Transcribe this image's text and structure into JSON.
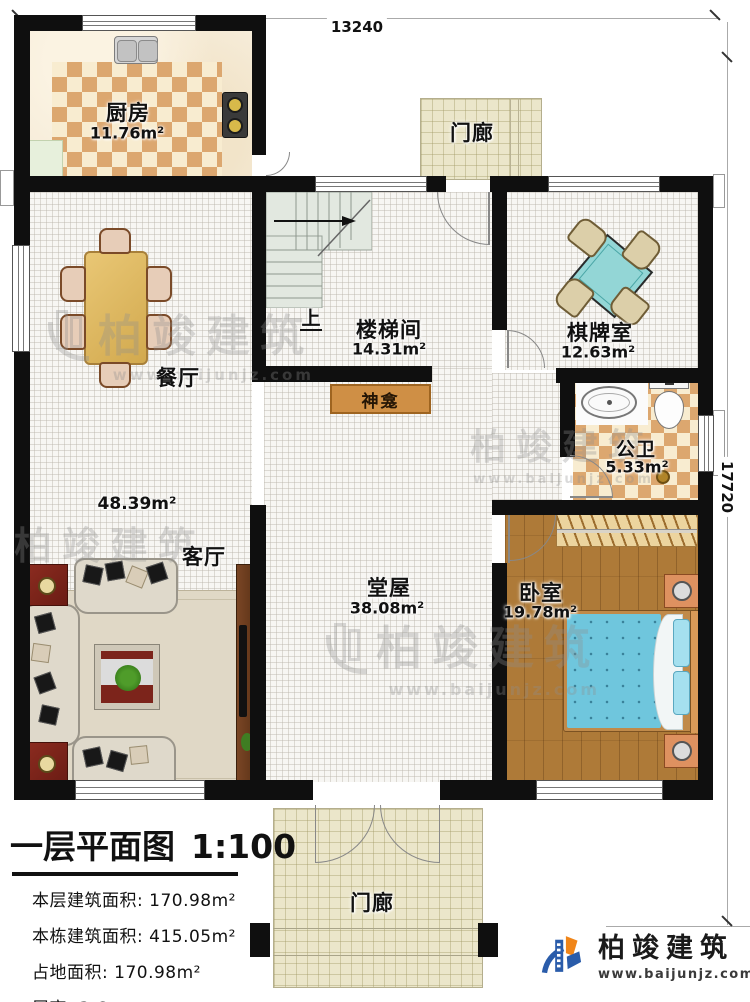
{
  "dimensions": {
    "top": "13240",
    "right": "17720"
  },
  "rooms": {
    "kitchen": {
      "name": "厨房",
      "area": "11.76m²"
    },
    "dining": {
      "name": "餐厅"
    },
    "stair": {
      "name": "楼梯间",
      "area": "14.31m²"
    },
    "chess": {
      "name": "棋牌室",
      "area": "12.63m²"
    },
    "bath": {
      "name": "公卫",
      "area": "5.33m²"
    },
    "bedroom": {
      "name": "卧室",
      "area": "19.78m²"
    },
    "living": {
      "name": "客厅",
      "area": "48.39m²"
    },
    "hall": {
      "name": "堂屋",
      "area": "38.08m²"
    },
    "porch_top": {
      "name": "门廊"
    },
    "porch_bottom": {
      "name": "门廊"
    },
    "shrine": {
      "name": "神龛"
    }
  },
  "stairs": {
    "up": "上"
  },
  "titleblock": {
    "title": "一层平面图",
    "scale": "1:100",
    "rows": [
      {
        "label": "本层建筑面积:",
        "value": "170.98m²"
      },
      {
        "label": "本栋建筑面积:",
        "value": "415.05m²"
      },
      {
        "label": "占地面积:",
        "value": "170.98m²"
      },
      {
        "label": "层高:",
        "value": "3.6m"
      }
    ]
  },
  "brand": {
    "name": "柏竣建筑",
    "site": "www.baijunjz.com"
  },
  "watermark": {
    "name": "柏竣建筑",
    "site": "www.baijunjz.com"
  },
  "colors": {
    "wall": "#0f0f0f",
    "checker_tan": "#dca76f",
    "wood_floor": "#ae7a38",
    "bed_blue": "#6fc6dd",
    "mahjong_teal": "#93d6d6",
    "shrine_wood": "#cf8f45",
    "porch_tile": "#ebe6ca",
    "logo_blue": "#2a5caa",
    "logo_orange": "#f08519",
    "watermark_gray": "#8f8f8f",
    "sofa_beige": "#dfd9cb",
    "accent_red_table": "#7c241b"
  }
}
